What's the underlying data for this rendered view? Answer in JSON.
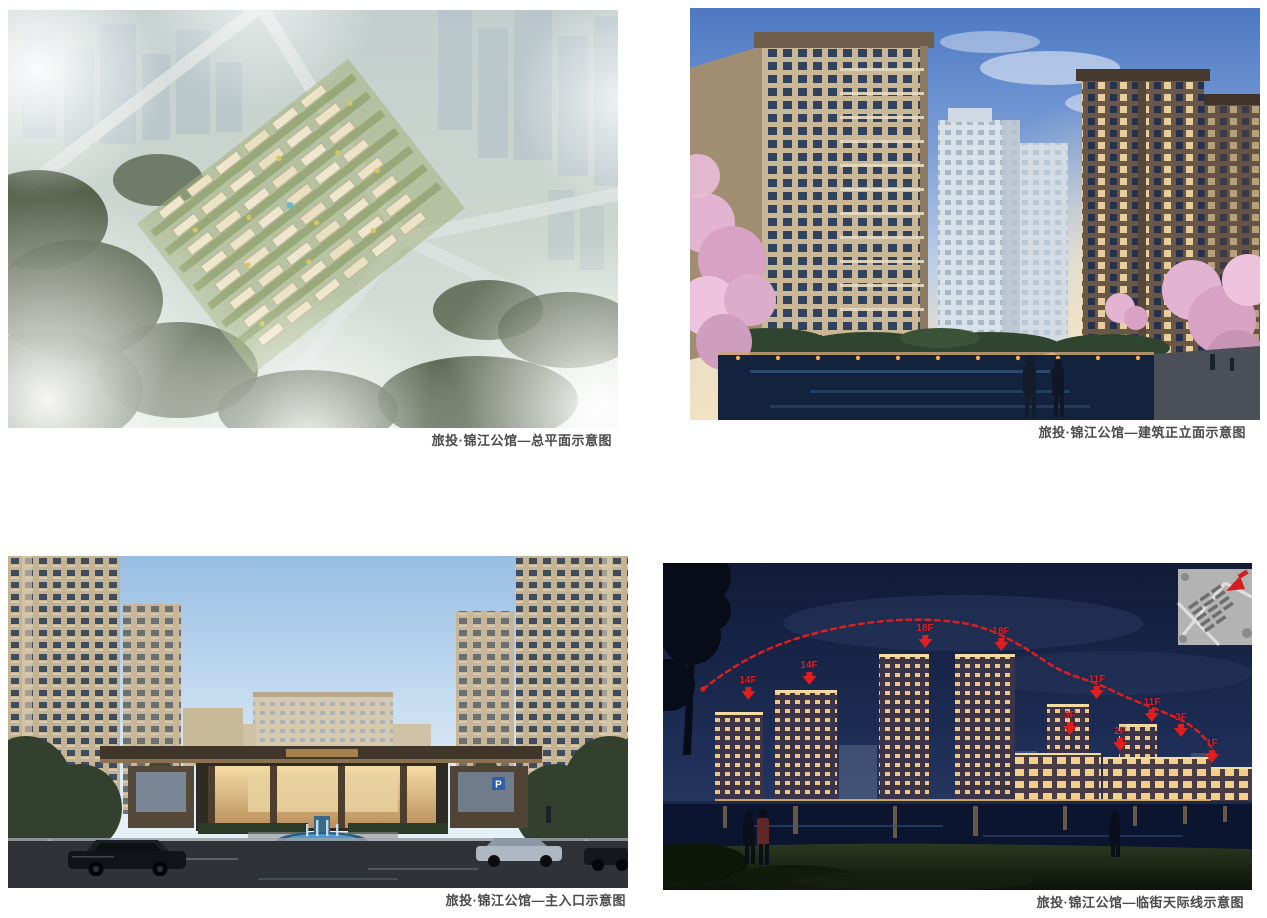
{
  "figures": {
    "site_plan": {
      "caption": "旅投·锦江公馆—总平面示意图"
    },
    "elevation": {
      "caption": "旅投·锦江公馆—建筑正立面示意图"
    },
    "entrance": {
      "caption": "旅投·锦江公馆—主入口示意图",
      "parking_sign": "P"
    },
    "skyline": {
      "caption": "旅投·锦江公馆—临街天际线示意图",
      "floor_labels": [
        "14F",
        "14F",
        "18F",
        "18F",
        "11F",
        "3F",
        "11F",
        "2F",
        "3F",
        "1F"
      ]
    }
  },
  "colors": {
    "page_background": "#ffffff",
    "caption_text": "#4a4a4a",
    "annotation_red": "#e01e1e"
  },
  "icons": {
    "down_arrow": "▼",
    "direction_arrow": "➤"
  }
}
